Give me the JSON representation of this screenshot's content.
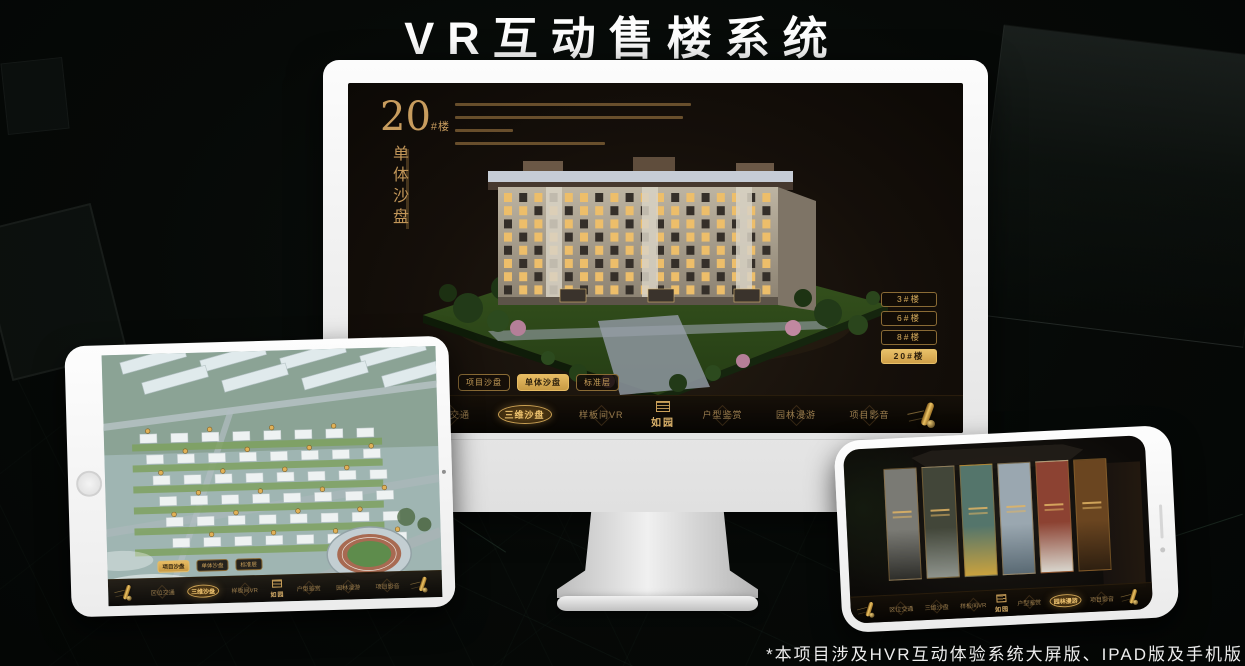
{
  "page": {
    "title": "VR互动售楼系统",
    "footnote": "*本项目涉及HVR互动体验系统大屏版、IPAD版及手机版"
  },
  "colors": {
    "gold": "#c79c5e",
    "gold_bright": "#f0c571",
    "active_pill": "#d8a854",
    "screen_bg": "#150f0a",
    "nav_bg": "#0a0704",
    "device_white": "#f2f2f2"
  },
  "monitor": {
    "block_title_number": "20",
    "block_title_unit": "#楼",
    "block_subtitle": "单体沙盘",
    "floor_buttons": [
      {
        "label": "3#楼",
        "active": false
      },
      {
        "label": "6#楼",
        "active": false
      },
      {
        "label": "8#楼",
        "active": false
      },
      {
        "label": "20#楼",
        "active": true
      }
    ],
    "sub_tabs": [
      {
        "label": "项目沙盘",
        "active": false
      },
      {
        "label": "单体沙盘",
        "active": true
      },
      {
        "label": "标准层",
        "active": false
      }
    ],
    "nav_active": "三维沙盘"
  },
  "tablet": {
    "sub_tabs": [
      {
        "label": "项目沙盘",
        "active": true
      },
      {
        "label": "单体沙盘",
        "active": false
      },
      {
        "label": "标准层",
        "active": false
      }
    ],
    "nav_active": "三维沙盘"
  },
  "phone": {
    "nav_active": "园林漫游",
    "gallery_cards": [
      {
        "name": "scene-card-1",
        "top": "#7a7a74",
        "bottom": "#2e2e2a"
      },
      {
        "name": "scene-card-2",
        "top": "#424639",
        "bottom": "#8e938c"
      },
      {
        "name": "scene-card-3",
        "top": "#54756b",
        "bottom": "#c9a23e"
      },
      {
        "name": "scene-card-4",
        "top": "#9aa7b0",
        "bottom": "#5a6a74"
      },
      {
        "name": "scene-card-5",
        "top": "#8c4232",
        "bottom": "#d8d5cc"
      },
      {
        "name": "scene-card-6",
        "top": "#6a4520",
        "bottom": "#2e1f10"
      }
    ]
  },
  "nav": {
    "logo": "如园",
    "items": [
      "区位交通",
      "三维沙盘",
      "样板间VR",
      "户型鉴赏",
      "园林漫游",
      "项目影音"
    ]
  }
}
